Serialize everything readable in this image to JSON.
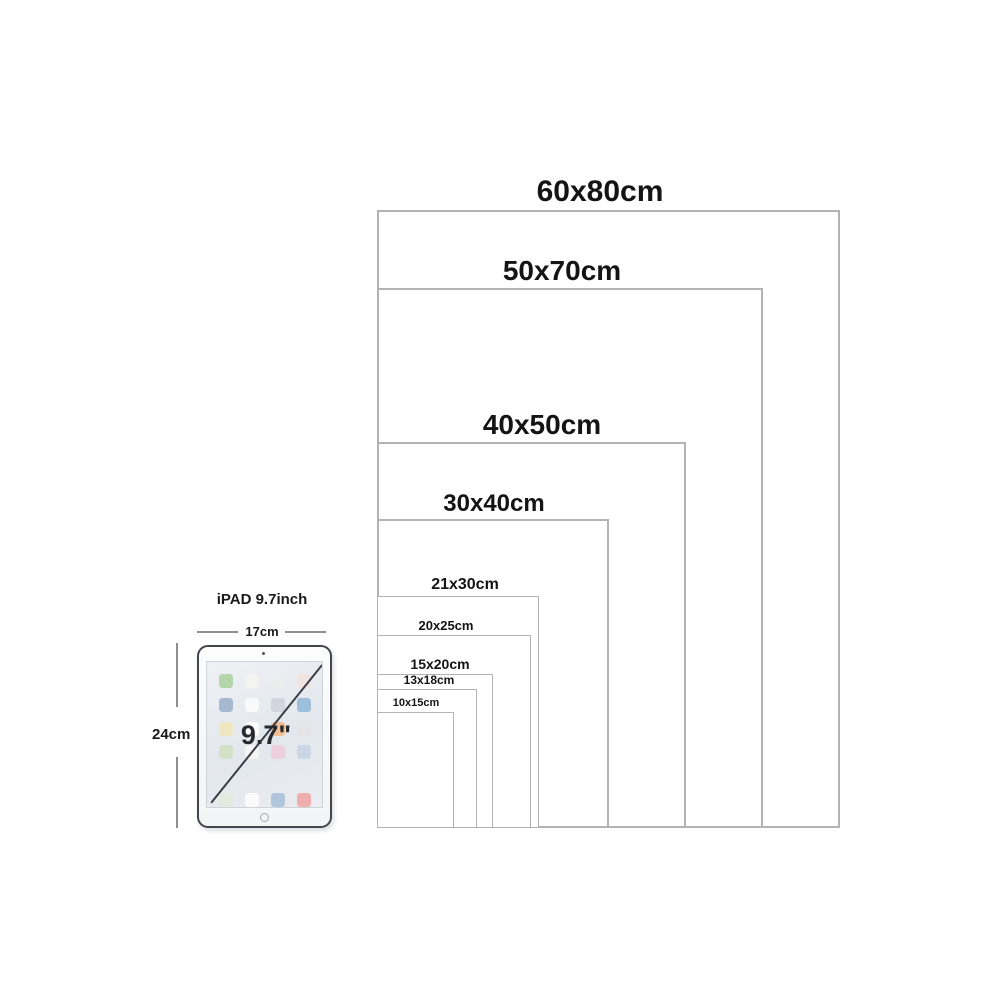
{
  "colors": {
    "background": "#ffffff",
    "frame_border": "#b3b3b3",
    "label_text": "#141414",
    "dimension_line": "#8f8f8f",
    "ipad_border": "#43464c",
    "diagonal_line": "#3a3f47"
  },
  "frames": [
    {
      "label": "60x80cm",
      "w_cm": 60,
      "h_cm": 80,
      "label_cx": 600,
      "font_px": 30
    },
    {
      "label": "50x70cm",
      "w_cm": 50,
      "h_cm": 70,
      "label_cx": 562,
      "font_px": 28
    },
    {
      "label": "40x50cm",
      "w_cm": 40,
      "h_cm": 50,
      "label_cx": 542,
      "font_px": 28
    },
    {
      "label": "30x40cm",
      "w_cm": 30,
      "h_cm": 40,
      "label_cx": 494,
      "font_px": 24
    },
    {
      "label": "21x30cm",
      "w_cm": 21,
      "h_cm": 30,
      "label_cx": 465,
      "font_px": 16
    },
    {
      "label": "20x25cm",
      "w_cm": 20,
      "h_cm": 25,
      "label_cx": 446,
      "font_px": 13
    },
    {
      "label": "15x20cm",
      "w_cm": 15,
      "h_cm": 20,
      "label_cx": 440,
      "font_px": 14
    },
    {
      "label": "13x18cm",
      "w_cm": 13,
      "h_cm": 18,
      "label_cx": 429,
      "font_px": 12
    },
    {
      "label": "10x15cm",
      "w_cm": 10,
      "h_cm": 15,
      "label_cx": 416,
      "font_px": 11
    }
  ],
  "ipad": {
    "title": "iPAD 9.7inch",
    "width_label": "17cm",
    "height_label": "24cm",
    "screen_size_label": "9.7\"",
    "app_icon_rows": [
      [
        "#aed3a2",
        "#f4f4ef",
        "#ececec",
        "#f2e2de"
      ],
      [
        "#9db3cb",
        "#fbfbfb",
        "#cfd3da",
        "#93bad9"
      ],
      [
        "#f0e6bd",
        "#fdfdfd",
        "#f2bb8a",
        "#e4e4e6"
      ],
      [
        "#cfe0c3",
        "#f6f6f4",
        "#eccdd9",
        "#c8d5e2"
      ]
    ],
    "dock_icons": [
      "#dfeadb",
      "#fdfdfd",
      "#a9c2d8",
      "#f0a9a4"
    ]
  }
}
